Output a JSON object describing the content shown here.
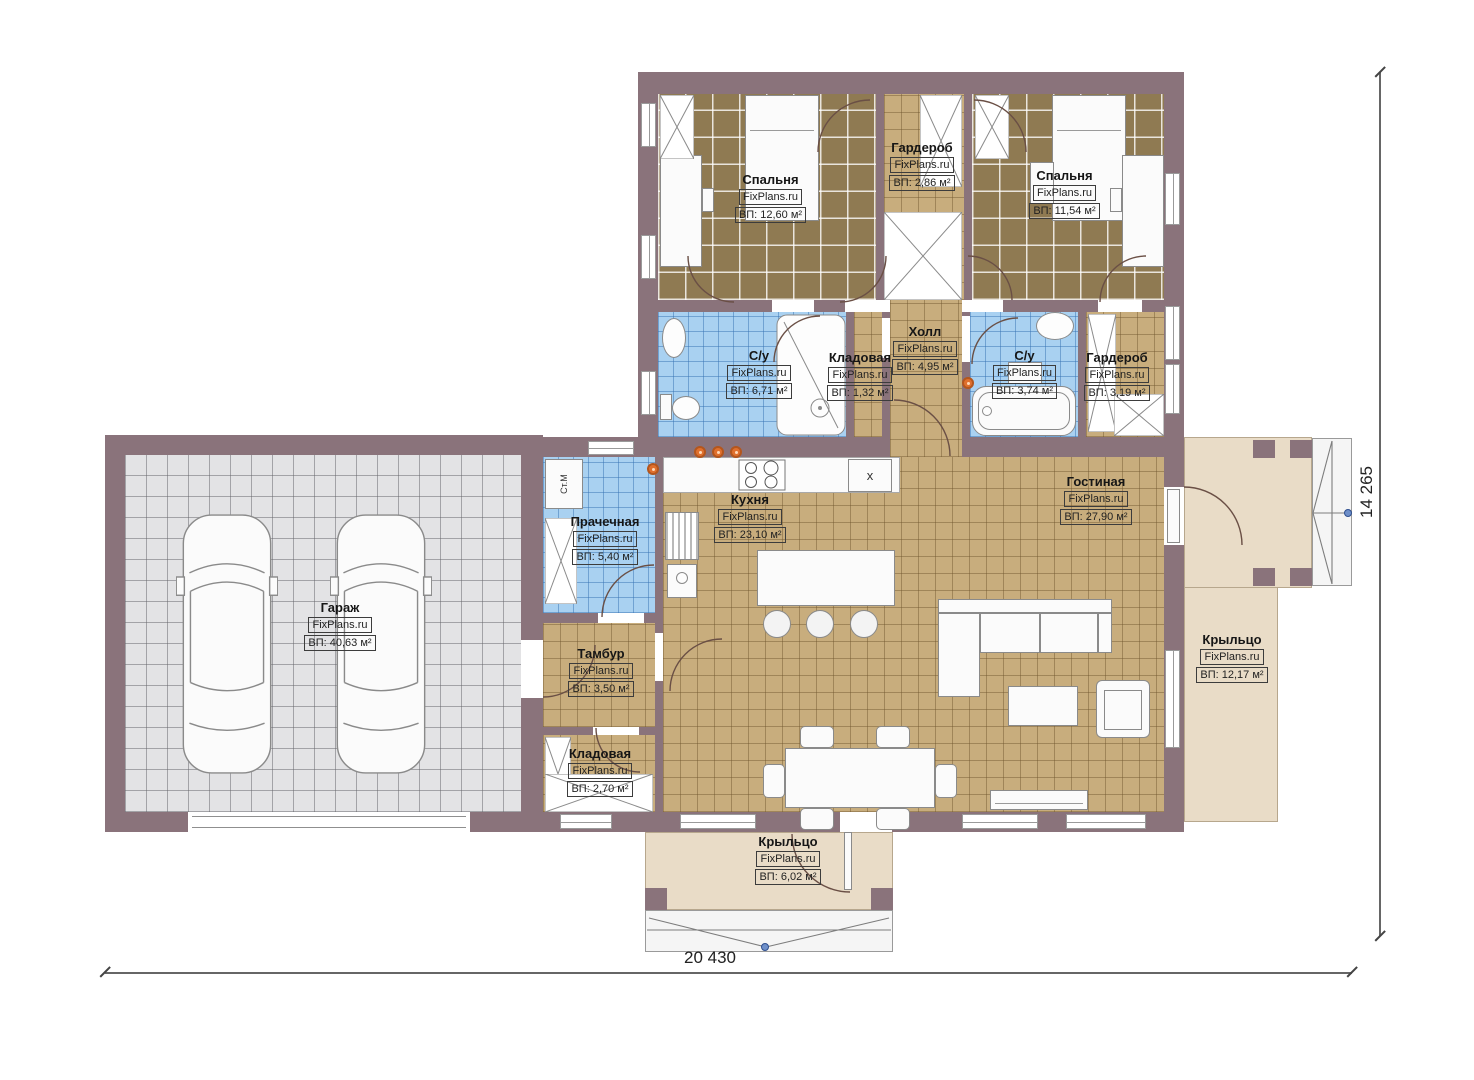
{
  "wm": "FixPlans.ru",
  "rooms": {
    "bedroom1": {
      "name": "Спальня",
      "area": "ВП: 12,60 м²"
    },
    "wardrobe_top": {
      "name": "Гардероб",
      "area": "ВП: 2,86 м²"
    },
    "bedroom2": {
      "name": "Спальня",
      "area": "ВП: 11,54 м²"
    },
    "bath1": {
      "name": "С/у",
      "area": "ВП: 6,71 м²"
    },
    "storage1": {
      "name": "Кладовая",
      "area": "ВП: 1,32 м²"
    },
    "hall": {
      "name": "Холл",
      "area": "ВП: 4,95 м²"
    },
    "bath2": {
      "name": "С/у",
      "area": "ВП: 3,74 м²"
    },
    "wardrobe2": {
      "name": "Гардероб",
      "area": "ВП: 3,19 м²"
    },
    "garage": {
      "name": "Гараж",
      "area": "ВП: 40,63 м²"
    },
    "laundry": {
      "name": "Прачечная",
      "area": "ВП: 5,40 м²"
    },
    "kitchen": {
      "name": "Кухня",
      "area": "ВП: 23,10 м²"
    },
    "living": {
      "name": "Гостиная",
      "area": "ВП: 27,90 м²"
    },
    "tambur": {
      "name": "Тамбур",
      "area": "ВП: 3,50 м²"
    },
    "storage2": {
      "name": "Кладовая",
      "area": "ВП: 2,70 м²"
    },
    "porch_right": {
      "name": "Крыльцо",
      "area": "ВП: 12,17 м²"
    },
    "porch_bottom": {
      "name": "Крыльцо",
      "area": "ВП: 6,02 м²"
    }
  },
  "dims": {
    "width_label": "20 430",
    "height_label": "14 265"
  },
  "labels": {
    "washer": "Ст.М",
    "sink_marker": "х"
  },
  "colors": {
    "wall": "#8a737b",
    "carpet": "#8f7a52",
    "tan": "#c8ad7d",
    "blue": "#a9d1f1",
    "gray": "#e3e3e5",
    "porch": "#e9dcc7",
    "accent": "#e0702e"
  }
}
